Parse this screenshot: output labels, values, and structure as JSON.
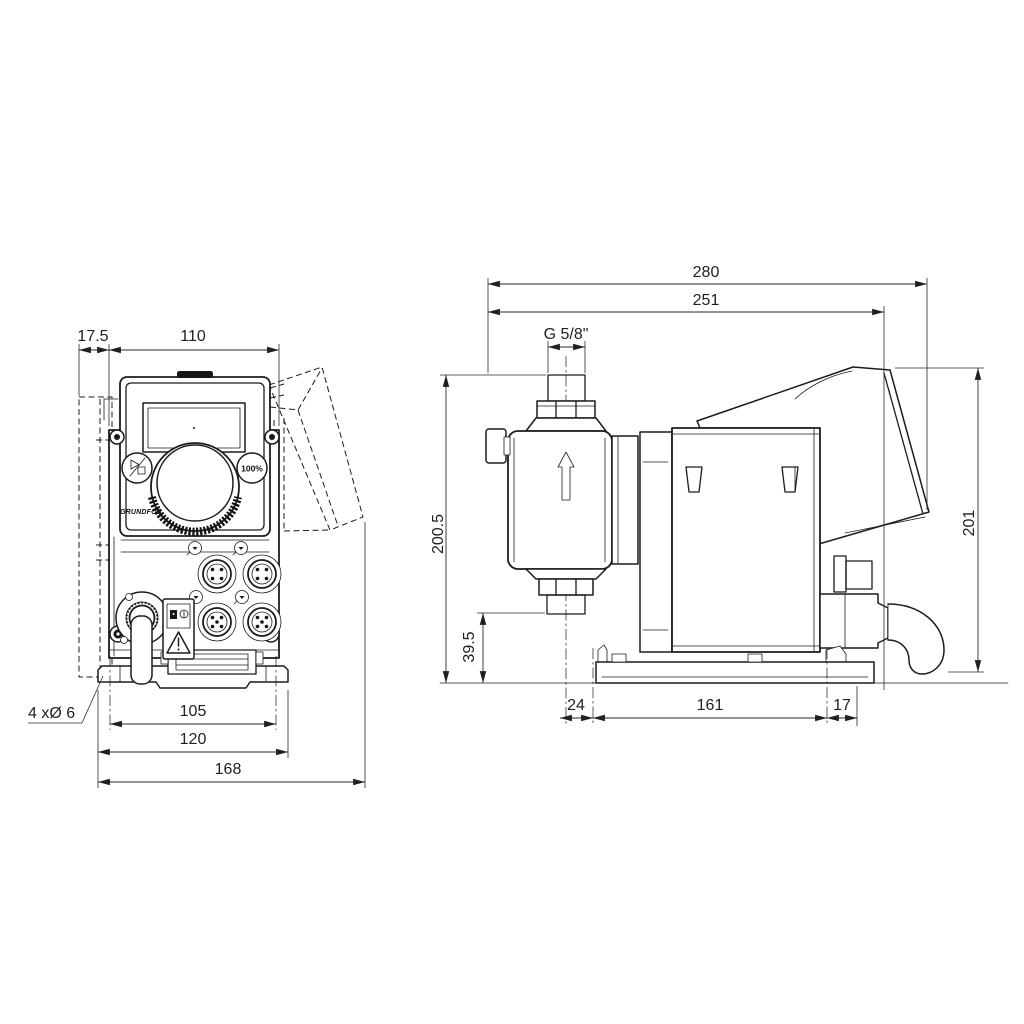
{
  "front": {
    "dims": {
      "wall_offset": "17.5",
      "body_width": "110",
      "hole_spacing": "105",
      "plate_width": "120",
      "overall_width": "168",
      "holes": "4 xØ 6"
    },
    "panel": {
      "brand": "GRUNDFOS",
      "percent_button": "100%"
    }
  },
  "side": {
    "dims": {
      "overall_depth": "280",
      "depth_to_cable_plug": "251",
      "connection_thread": "G 5/8\"",
      "height_base_to_outlet": "200.5",
      "height_base_to_inlet": "39.5",
      "overall_height": "201",
      "base_front_offset": "24",
      "hole_spacing": "161",
      "base_rear_offset": "17"
    }
  },
  "icons": {
    "start_stop": "start-stop-icon",
    "percent": "100-percent-icon",
    "warning": "warning-triangle-icon",
    "manual": "read-manual-icon",
    "flow": "flow-direction-arrow-icon"
  }
}
